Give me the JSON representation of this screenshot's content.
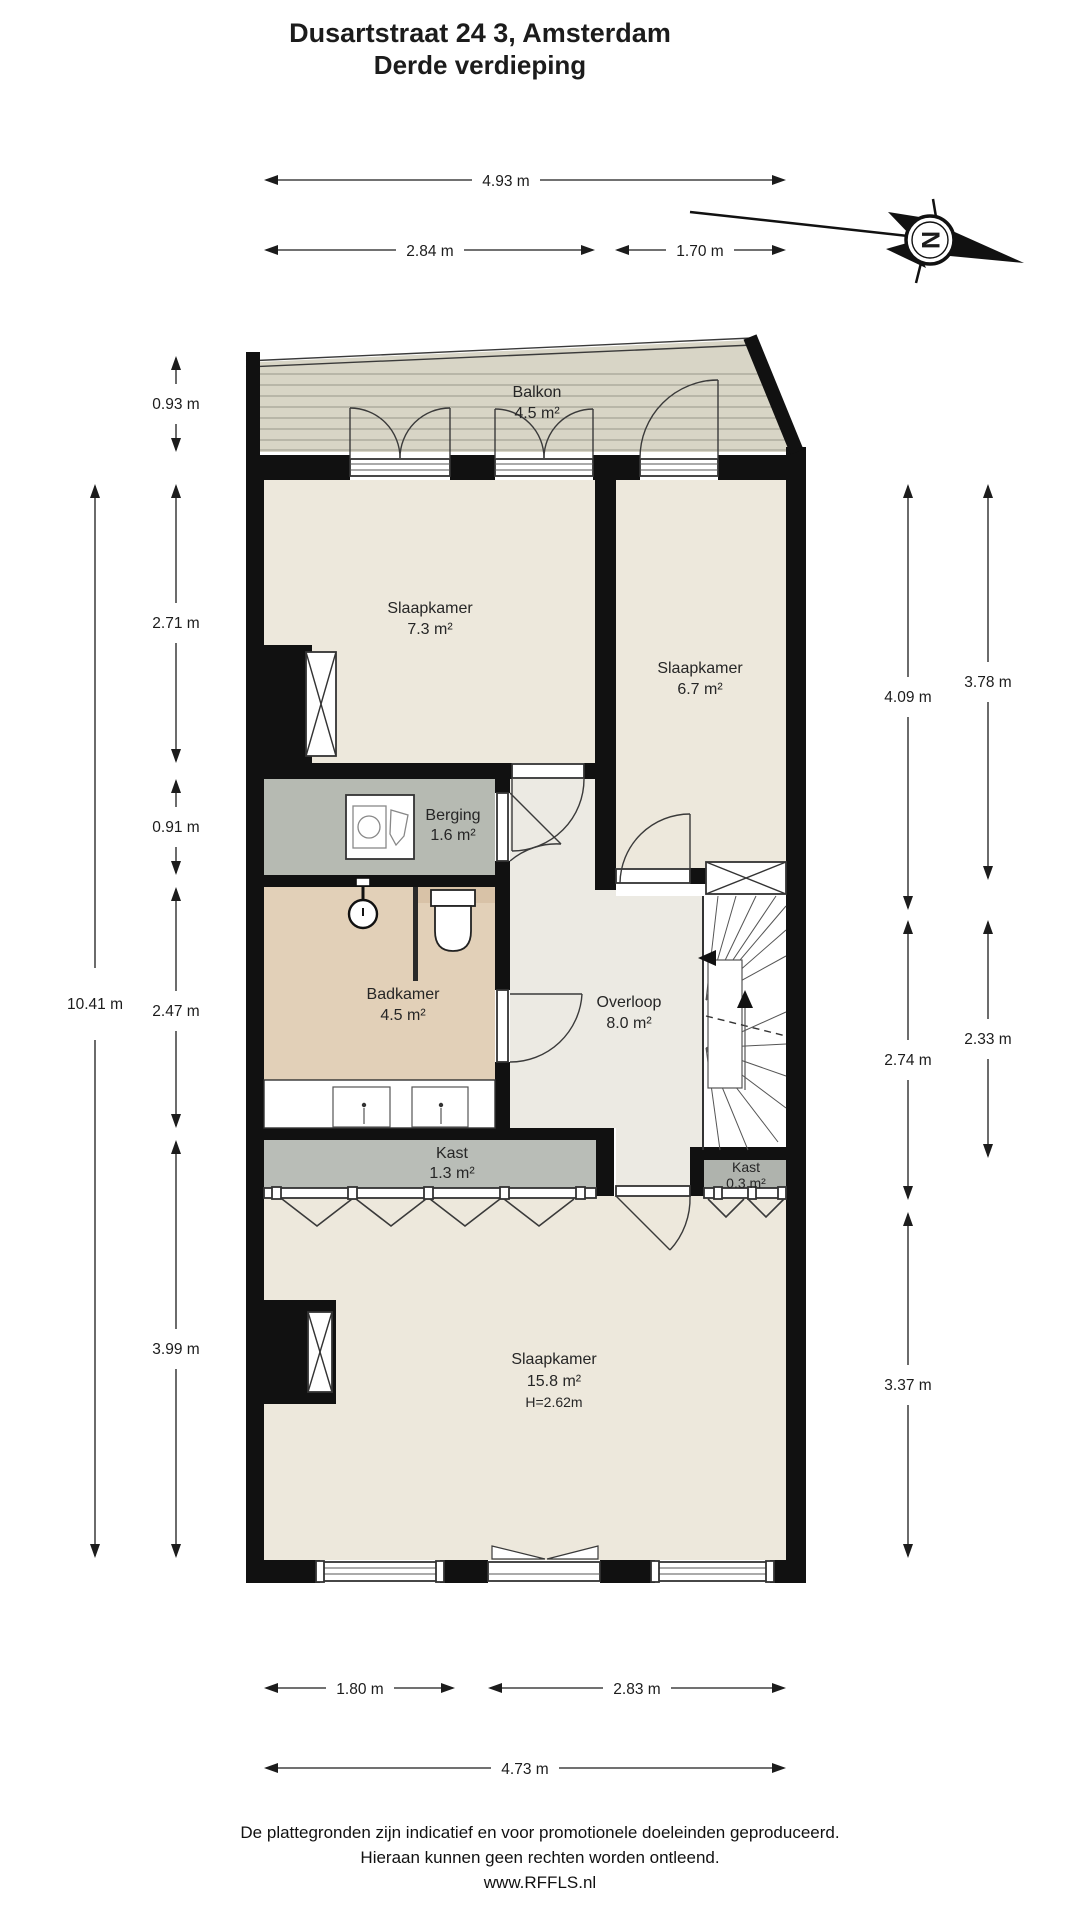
{
  "title": {
    "line1": "Dusartstraat 24 3, Amsterdam",
    "line2": "Derde verdieping"
  },
  "compass": {
    "north_label": "N"
  },
  "rooms": {
    "balkon": {
      "name": "Balkon",
      "area": "4.5 m²"
    },
    "slaapkamer_73": {
      "name": "Slaapkamer",
      "area": "7.3 m²"
    },
    "slaapkamer_67": {
      "name": "Slaapkamer",
      "area": "6.7 m²"
    },
    "berging": {
      "name": "Berging",
      "area": "1.6 m²"
    },
    "badkamer": {
      "name": "Badkamer",
      "area": "4.5 m²"
    },
    "overloop": {
      "name": "Overloop",
      "area": "8.0 m²"
    },
    "kast_13": {
      "name": "Kast",
      "area": "1.3 m²"
    },
    "kast_03": {
      "name": "Kast",
      "area": "0.3 m²"
    },
    "slaapkamer_158": {
      "name": "Slaapkamer",
      "area": "15.8 m²",
      "height": "H=2.62m"
    }
  },
  "dims": {
    "top": [
      "4.93 m",
      "2.84 m",
      "1.70 m"
    ],
    "left": [
      "0.93 m",
      "2.71 m",
      "0.91 m",
      "2.47 m",
      "3.99 m"
    ],
    "left_total": "10.41 m",
    "right": [
      "4.09 m",
      "2.74 m",
      "3.37 m"
    ],
    "right_outer": [
      "3.78 m",
      "2.33 m"
    ],
    "bottom": [
      "1.80 m",
      "2.83 m"
    ],
    "bottom_total": "4.73 m"
  },
  "footer": {
    "line1": "De plattegronden zijn indicatief en voor promotionele doeleinden geproduceerd.",
    "line2": "Hieraan kunnen geen rechten worden ontleend.",
    "line3": "www.RFFLS.nl"
  },
  "colors": {
    "wall": "#111111",
    "room_cream": "#EDE8DC",
    "hall": "#ECEAE3",
    "balcony": "#D8D5C6",
    "storage_gray": "#B6BAB2",
    "closet_gray": "#B9BDB7",
    "bathroom_tan": "#E2D0B8",
    "text": "#1c1c1c"
  }
}
